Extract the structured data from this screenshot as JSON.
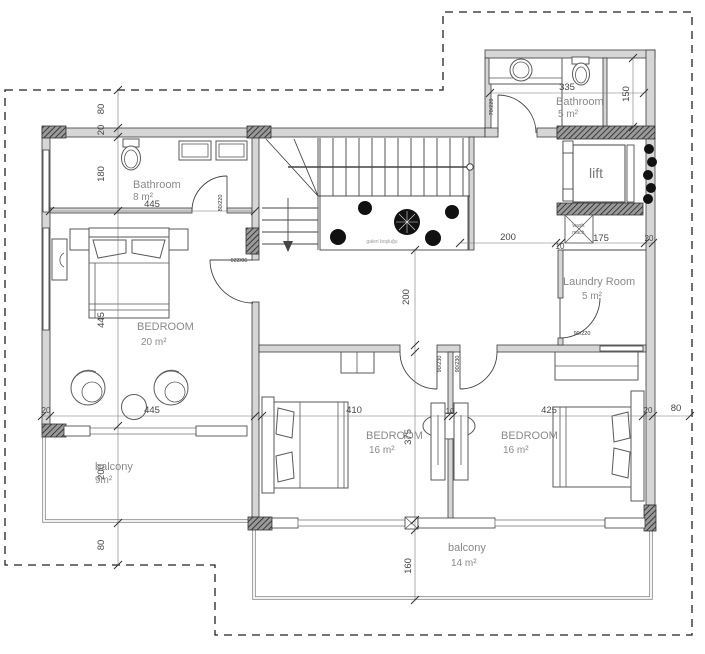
{
  "rooms": {
    "bathroom8": {
      "name": "Bathroom",
      "area": "8 m²"
    },
    "bedroom20": {
      "name": "BEDROOM",
      "area": "20 m²"
    },
    "balcony9": {
      "name": "balcony",
      "area": "9m²"
    },
    "bathroom5": {
      "name": "Bathroom",
      "area": "5 m²"
    },
    "lift": {
      "name": "lift"
    },
    "laundry": {
      "name": "Laundry Room",
      "area": "5 m²"
    },
    "bedroom16a": {
      "name": "BEDROOM",
      "area": "16 m²"
    },
    "bedroom16b": {
      "name": "BEDROOM",
      "area": "16 m²"
    },
    "balcony14": {
      "name": "balcony",
      "area": "14 m²"
    },
    "gallery": {
      "label": "galeri boşluğu"
    },
    "washing_machine": {
      "line1": "wash.",
      "line2": "mach."
    }
  },
  "dims": [
    "80",
    "20",
    "180",
    "445",
    "445",
    "20",
    "445",
    "200",
    "80",
    "335",
    "150",
    "200",
    "10",
    "175",
    "20",
    "200",
    "410",
    "10",
    "375",
    "425",
    "20",
    "80",
    "160"
  ],
  "door_labels": [
    "80/220",
    "90/220",
    "90/230",
    "90/230",
    "90/220",
    "70/220"
  ]
}
